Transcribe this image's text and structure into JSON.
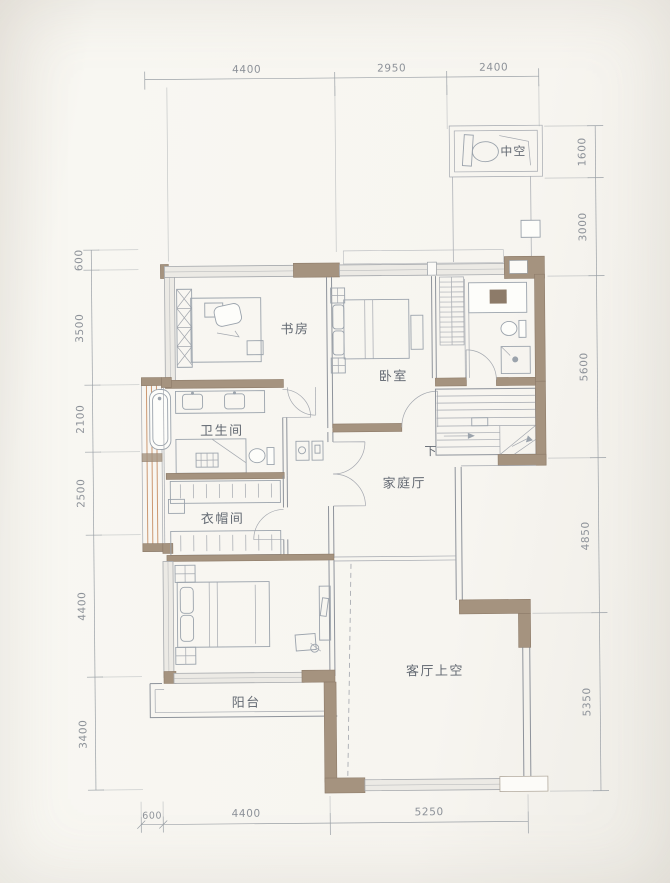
{
  "plan": {
    "type": "residential-floor-plan-upper-level",
    "rooms": {
      "void_top": "中空",
      "study": "书房",
      "bedroom": "卧室",
      "bathroom": "卫生间",
      "cloakroom": "衣帽间",
      "family_hall": "家庭厅",
      "stair_down": "下",
      "balcony": "阳台",
      "living_void": "客厅上空"
    },
    "dimensions": {
      "top": [
        "4400",
        "2950",
        "2400"
      ],
      "right": [
        "1600",
        "3000",
        "5600",
        "4850",
        "5350"
      ],
      "left": [
        "600",
        "3500",
        "2100",
        "2500",
        "4400",
        "3400"
      ],
      "bottom": [
        "600",
        "4400",
        "5250"
      ]
    },
    "colors": {
      "background": "#f6f4ef",
      "wall_solid": "#a5937f",
      "wall_dark": "#8d7b69",
      "wall_light": "#eceae5",
      "line": "#8e939b",
      "furniture_line": "#9ba3ac",
      "accent_wood": "#c4875c",
      "text": "#646a73",
      "dim_text": "#8d9299"
    }
  }
}
